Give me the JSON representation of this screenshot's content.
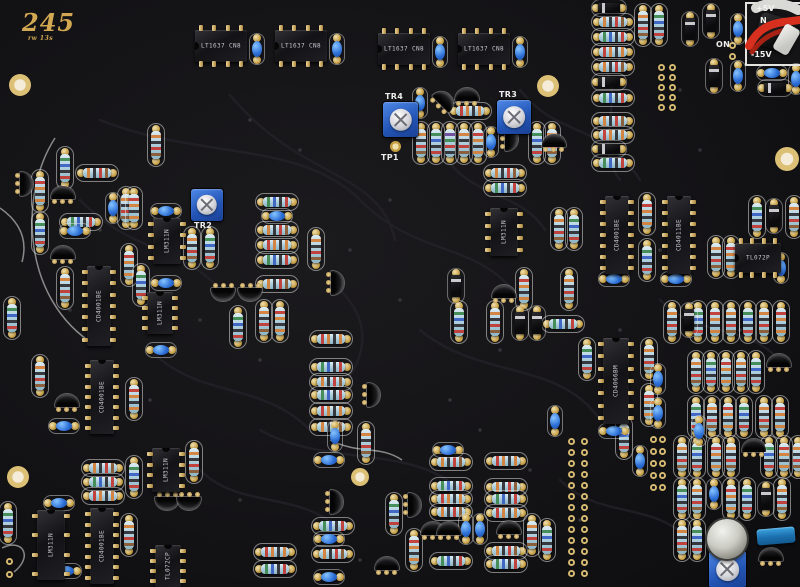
{
  "board": {
    "title": "245",
    "subtitle": "rw 13s",
    "colors": {
      "background": "#121114",
      "silkscreen": "#ececea",
      "pad_gold": "#c59e42",
      "resistor_body": "#a9cbda",
      "capacitor_blue": "#2d6fd6",
      "trimmer_blue": "#2254b4",
      "ic_black": "#131316",
      "wire_red": "#d8301e",
      "title_gold": "#d2a852"
    }
  },
  "silk_labels": [
    {
      "t": "TR4",
      "x": 385,
      "y": 92
    },
    {
      "t": "TR3",
      "x": 499,
      "y": 90
    },
    {
      "t": "TR2",
      "x": 194,
      "y": 221
    }
  ],
  "test_point": {
    "label": "TP1",
    "x": 390,
    "y": 141,
    "lx": 381,
    "ly": 153
  },
  "power": {
    "box": {
      "x": 745,
      "y": 2,
      "w": 53,
      "h": 60
    },
    "labels": [
      {
        "t": "+5V",
        "x": 756,
        "y": 4
      },
      {
        "t": "N",
        "x": 760,
        "y": 16
      },
      {
        "t": "-15V",
        "x": 751,
        "y": 50
      }
    ],
    "on": {
      "t": "ON",
      "x": 716,
      "y": 40
    }
  },
  "ics": [
    {
      "x": 195,
      "y": 25,
      "w": 52,
      "h": 42,
      "pins": 4,
      "o": "h",
      "label": "LT1637 CN8"
    },
    {
      "x": 275,
      "y": 25,
      "w": 52,
      "h": 42,
      "pins": 4,
      "o": "h",
      "label": "LT1637 CN8"
    },
    {
      "x": 378,
      "y": 28,
      "w": 52,
      "h": 42,
      "pins": 4,
      "o": "h",
      "label": "LT1637 CN8"
    },
    {
      "x": 458,
      "y": 28,
      "w": 52,
      "h": 42,
      "pins": 4,
      "o": "h",
      "label": "LT1637 CN8"
    },
    {
      "x": 82,
      "y": 266,
      "w": 34,
      "h": 80,
      "pins": 7,
      "o": "v",
      "label": "CD4001BE"
    },
    {
      "x": 85,
      "y": 360,
      "w": 34,
      "h": 74,
      "pins": 7,
      "o": "v",
      "label": "CD4001BE"
    },
    {
      "x": 85,
      "y": 508,
      "w": 34,
      "h": 76,
      "pins": 7,
      "o": "v",
      "label": "CD4001BE"
    },
    {
      "x": 142,
      "y": 292,
      "w": 36,
      "h": 42,
      "pins": 4,
      "o": "v",
      "label": "LM311N"
    },
    {
      "x": 148,
      "y": 218,
      "w": 38,
      "h": 46,
      "pins": 4,
      "o": "v",
      "label": "LM311N"
    },
    {
      "x": 485,
      "y": 208,
      "w": 38,
      "h": 48,
      "pins": 4,
      "o": "v",
      "label": "LM311N"
    },
    {
      "x": 600,
      "y": 196,
      "w": 34,
      "h": 78,
      "pins": 7,
      "o": "v",
      "label": "CD4001BE"
    },
    {
      "x": 662,
      "y": 196,
      "w": 34,
      "h": 78,
      "pins": 7,
      "o": "v",
      "label": "CD4011BE"
    },
    {
      "x": 598,
      "y": 338,
      "w": 36,
      "h": 86,
      "pins": 7,
      "o": "v",
      "label": "CD4066BM"
    },
    {
      "x": 735,
      "y": 238,
      "w": 46,
      "h": 40,
      "pins": 4,
      "o": "h",
      "label": "TL072P"
    },
    {
      "x": 32,
      "y": 510,
      "w": 38,
      "h": 70,
      "pins": 4,
      "o": "v",
      "label": "LM311N"
    },
    {
      "x": 147,
      "y": 448,
      "w": 38,
      "h": 44,
      "pins": 4,
      "o": "v",
      "label": "LM311N"
    },
    {
      "x": 150,
      "y": 545,
      "w": 36,
      "h": 42,
      "pins": 4,
      "o": "v",
      "label": "TL072CP"
    }
  ],
  "trimmers": [
    {
      "x": 383,
      "y": 102,
      "s": 35,
      "label": "TR4"
    },
    {
      "x": 497,
      "y": 100,
      "s": 34,
      "label": "TR3"
    },
    {
      "x": 191,
      "y": 189,
      "s": 32,
      "label": "TR2"
    },
    {
      "x": 709,
      "y": 551,
      "s": 37,
      "label": ""
    }
  ],
  "band_variants": [
    [
      "#d4803a",
      "#303035",
      "#c23b35",
      "#8a5a33"
    ],
    [
      "#3f8a52",
      "#3a62c2",
      "#303035",
      "#c23b35"
    ],
    [
      "#c23b35",
      "#d4803a",
      "#303035",
      "#d4803a"
    ],
    [
      "#6a4a9a",
      "#3f8a52",
      "#c23b35",
      "#303035"
    ],
    [
      "#303035",
      "#d4803a",
      "#3a62c2",
      "#c23b35"
    ]
  ],
  "resistors": [
    [
      592,
      14,
      "h",
      0
    ],
    [
      592,
      29,
      "h",
      1
    ],
    [
      592,
      44,
      "h",
      2
    ],
    [
      592,
      59,
      "h",
      0
    ],
    [
      592,
      90,
      "h",
      1
    ],
    [
      592,
      113,
      "h",
      0
    ],
    [
      592,
      127,
      "h",
      2
    ],
    [
      592,
      155,
      "h",
      1
    ],
    [
      635,
      4,
      "v",
      0
    ],
    [
      651,
      4,
      "v",
      1
    ],
    [
      449,
      103,
      "h",
      2
    ],
    [
      413,
      122,
      "v",
      0
    ],
    [
      428,
      122,
      "v",
      1
    ],
    [
      442,
      122,
      "v",
      3
    ],
    [
      456,
      122,
      "v",
      0
    ],
    [
      470,
      122,
      "v",
      2
    ],
    [
      529,
      122,
      "v",
      1
    ],
    [
      544,
      122,
      "v",
      0
    ],
    [
      484,
      165,
      "h",
      0
    ],
    [
      484,
      180,
      "h",
      1
    ],
    [
      57,
      147,
      "v",
      1
    ],
    [
      76,
      165,
      "h",
      0
    ],
    [
      32,
      170,
      "v",
      2
    ],
    [
      32,
      212,
      "v",
      1
    ],
    [
      60,
      214,
      "h",
      1
    ],
    [
      118,
      187,
      "v",
      0
    ],
    [
      57,
      267,
      "v",
      0
    ],
    [
      121,
      244,
      "v",
      2
    ],
    [
      133,
      264,
      "v",
      1
    ],
    [
      148,
      124,
      "v",
      0
    ],
    [
      4,
      297,
      "v",
      1
    ],
    [
      32,
      355,
      "v",
      0
    ],
    [
      126,
      187,
      "v",
      2
    ],
    [
      184,
      227,
      "v",
      0
    ],
    [
      202,
      227,
      "v",
      1
    ],
    [
      308,
      228,
      "v",
      0
    ],
    [
      256,
      194,
      "h",
      1
    ],
    [
      256,
      222,
      "h",
      0
    ],
    [
      256,
      237,
      "h",
      2
    ],
    [
      256,
      252,
      "h",
      1
    ],
    [
      256,
      276,
      "h",
      0
    ],
    [
      230,
      306,
      "v",
      1
    ],
    [
      256,
      300,
      "v",
      0
    ],
    [
      272,
      300,
      "v",
      2
    ],
    [
      310,
      331,
      "h",
      2
    ],
    [
      310,
      359,
      "h",
      1
    ],
    [
      310,
      374,
      "h",
      0
    ],
    [
      310,
      387,
      "h",
      1
    ],
    [
      310,
      403,
      "h",
      2
    ],
    [
      310,
      419,
      "h",
      0
    ],
    [
      82,
      460,
      "h",
      0
    ],
    [
      82,
      474,
      "h",
      1
    ],
    [
      82,
      488,
      "h",
      2
    ],
    [
      126,
      456,
      "v",
      1
    ],
    [
      121,
      514,
      "v",
      0
    ],
    [
      126,
      378,
      "v",
      2
    ],
    [
      0,
      502,
      "v",
      1
    ],
    [
      312,
      518,
      "h",
      1
    ],
    [
      312,
      546,
      "h",
      0
    ],
    [
      254,
      544,
      "h",
      2
    ],
    [
      254,
      561,
      "h",
      1
    ],
    [
      358,
      422,
      "v",
      0
    ],
    [
      386,
      493,
      "v",
      1
    ],
    [
      406,
      529,
      "v",
      2
    ],
    [
      186,
      441,
      "v",
      0
    ],
    [
      430,
      454,
      "h",
      0
    ],
    [
      430,
      478,
      "h",
      1
    ],
    [
      430,
      491,
      "h",
      2
    ],
    [
      430,
      504,
      "h",
      0
    ],
    [
      430,
      553,
      "h",
      1
    ],
    [
      485,
      453,
      "h",
      2
    ],
    [
      485,
      479,
      "h",
      0
    ],
    [
      485,
      491,
      "h",
      1
    ],
    [
      485,
      505,
      "h",
      2
    ],
    [
      485,
      543,
      "h",
      0
    ],
    [
      485,
      556,
      "h",
      1
    ],
    [
      524,
      514,
      "v",
      0
    ],
    [
      539,
      519,
      "v",
      1
    ],
    [
      451,
      301,
      "v",
      1
    ],
    [
      487,
      301,
      "v",
      0
    ],
    [
      516,
      268,
      "v",
      2
    ],
    [
      561,
      268,
      "v",
      0
    ],
    [
      542,
      316,
      "h",
      1
    ],
    [
      551,
      208,
      "v",
      0
    ],
    [
      566,
      208,
      "v",
      1
    ],
    [
      639,
      193,
      "v",
      2
    ],
    [
      639,
      239,
      "v",
      1
    ],
    [
      749,
      196,
      "v",
      1
    ],
    [
      786,
      196,
      "v",
      0
    ],
    [
      708,
      236,
      "v",
      0
    ],
    [
      723,
      236,
      "v",
      2
    ],
    [
      579,
      338,
      "v",
      1
    ],
    [
      641,
      338,
      "v",
      0
    ],
    [
      641,
      384,
      "v",
      2
    ],
    [
      688,
      351,
      "v",
      0
    ],
    [
      703,
      351,
      "v",
      1
    ],
    [
      718,
      351,
      "v",
      2
    ],
    [
      733,
      351,
      "v",
      0
    ],
    [
      748,
      351,
      "v",
      1
    ],
    [
      688,
      396,
      "v",
      1
    ],
    [
      704,
      396,
      "v",
      0
    ],
    [
      720,
      396,
      "v",
      2
    ],
    [
      736,
      396,
      "v",
      1
    ],
    [
      756,
      396,
      "v",
      0
    ],
    [
      772,
      396,
      "v",
      2
    ],
    [
      616,
      417,
      "v",
      1
    ],
    [
      664,
      301,
      "v",
      0
    ],
    [
      690,
      301,
      "v",
      1
    ],
    [
      707,
      301,
      "v",
      2
    ],
    [
      723,
      301,
      "v",
      0
    ],
    [
      740,
      301,
      "v",
      1
    ],
    [
      756,
      301,
      "v",
      0
    ],
    [
      773,
      301,
      "v",
      2
    ],
    [
      674,
      436,
      "v",
      0
    ],
    [
      689,
      436,
      "v",
      1
    ],
    [
      708,
      436,
      "v",
      2
    ],
    [
      723,
      436,
      "v",
      0
    ],
    [
      761,
      436,
      "v",
      1
    ],
    [
      776,
      436,
      "v",
      2
    ],
    [
      790,
      436,
      "v",
      0
    ],
    [
      674,
      478,
      "v",
      1
    ],
    [
      689,
      478,
      "v",
      0
    ],
    [
      723,
      478,
      "v",
      2
    ],
    [
      739,
      478,
      "v",
      1
    ],
    [
      774,
      478,
      "v",
      0
    ],
    [
      674,
      519,
      "v",
      0
    ],
    [
      689,
      519,
      "v",
      1
    ]
  ],
  "capacitors": [
    [
      250,
      34,
      "v"
    ],
    [
      330,
      34,
      "v"
    ],
    [
      433,
      37,
      "v"
    ],
    [
      513,
      37,
      "v"
    ],
    [
      413,
      88,
      "v"
    ],
    [
      484,
      127,
      "v"
    ],
    [
      731,
      14,
      "v"
    ],
    [
      731,
      61,
      "v"
    ],
    [
      757,
      66,
      "h"
    ],
    [
      789,
      64,
      "v"
    ],
    [
      262,
      209,
      "h"
    ],
    [
      151,
      204,
      "h"
    ],
    [
      151,
      276,
      "h"
    ],
    [
      106,
      193,
      "v"
    ],
    [
      60,
      224,
      "h"
    ],
    [
      146,
      343,
      "h"
    ],
    [
      49,
      419,
      "h"
    ],
    [
      44,
      496,
      "h"
    ],
    [
      51,
      564,
      "h"
    ],
    [
      314,
      453,
      "h"
    ],
    [
      314,
      532,
      "h"
    ],
    [
      314,
      570,
      "h"
    ],
    [
      433,
      443,
      "h"
    ],
    [
      459,
      514,
      "v"
    ],
    [
      473,
      514,
      "v"
    ],
    [
      328,
      421,
      "v"
    ],
    [
      651,
      364,
      "v"
    ],
    [
      651,
      398,
      "v"
    ],
    [
      633,
      446,
      "v"
    ],
    [
      548,
      406,
      "v"
    ],
    [
      692,
      416,
      "v"
    ],
    [
      599,
      272,
      "h"
    ],
    [
      661,
      272,
      "h"
    ],
    [
      599,
      424,
      "h"
    ],
    [
      774,
      253,
      "v"
    ],
    [
      707,
      479,
      "v"
    ]
  ],
  "transistors": [
    [
      12,
      174,
      90
    ],
    [
      50,
      184,
      0
    ],
    [
      50,
      244,
      0
    ],
    [
      210,
      283,
      180
    ],
    [
      237,
      283,
      180
    ],
    [
      323,
      273,
      90
    ],
    [
      431,
      91,
      45
    ],
    [
      454,
      86,
      0
    ],
    [
      497,
      129,
      90
    ],
    [
      541,
      132,
      0
    ],
    [
      491,
      283,
      0
    ],
    [
      741,
      437,
      0
    ],
    [
      322,
      492,
      90
    ],
    [
      400,
      495,
      90
    ],
    [
      420,
      520,
      0
    ],
    [
      436,
      520,
      0
    ],
    [
      496,
      519,
      0
    ],
    [
      359,
      385,
      90
    ],
    [
      374,
      555,
      0
    ],
    [
      766,
      352,
      0
    ],
    [
      758,
      546,
      0
    ],
    [
      154,
      492,
      180
    ],
    [
      176,
      492,
      180
    ],
    [
      54,
      392,
      0
    ]
  ],
  "diodes": [
    [
      592,
      0,
      "h"
    ],
    [
      592,
      74,
      "h"
    ],
    [
      592,
      141,
      "h"
    ],
    [
      703,
      4,
      "v"
    ],
    [
      706,
      59,
      "v"
    ],
    [
      758,
      80,
      "h"
    ],
    [
      682,
      12,
      "v"
    ],
    [
      766,
      199,
      "v"
    ],
    [
      448,
      269,
      "v"
    ],
    [
      512,
      306,
      "v"
    ],
    [
      529,
      306,
      "v"
    ],
    [
      681,
      303,
      "v"
    ],
    [
      758,
      482,
      "v"
    ]
  ],
  "holes": [
    [
      20,
      85,
      11
    ],
    [
      548,
      86,
      11
    ],
    [
      787,
      159,
      12
    ],
    [
      18,
      477,
      11
    ],
    [
      360,
      477,
      9
    ]
  ],
  "pad_groups": [
    {
      "x": 658,
      "y": 64,
      "cols": 2,
      "rows": 5,
      "dx": 11,
      "dy": 10
    },
    {
      "x": 650,
      "y": 436,
      "cols": 2,
      "rows": 5,
      "dx": 9,
      "dy": 12
    },
    {
      "x": 568,
      "y": 438,
      "cols": 2,
      "rows": 13,
      "dx": 13,
      "dy": 11
    },
    {
      "x": 729,
      "y": 42,
      "cols": 1,
      "rows": 2,
      "dx": 0,
      "dy": 11
    },
    {
      "x": 6,
      "y": 558,
      "cols": 1,
      "rows": 2,
      "dx": 0,
      "dy": 13
    }
  ],
  "metal_can": {
    "x": 707,
    "y": 519,
    "d": 40
  },
  "box_capacitor": {
    "x": 757,
    "y": 528,
    "w": 38,
    "h": 16
  }
}
